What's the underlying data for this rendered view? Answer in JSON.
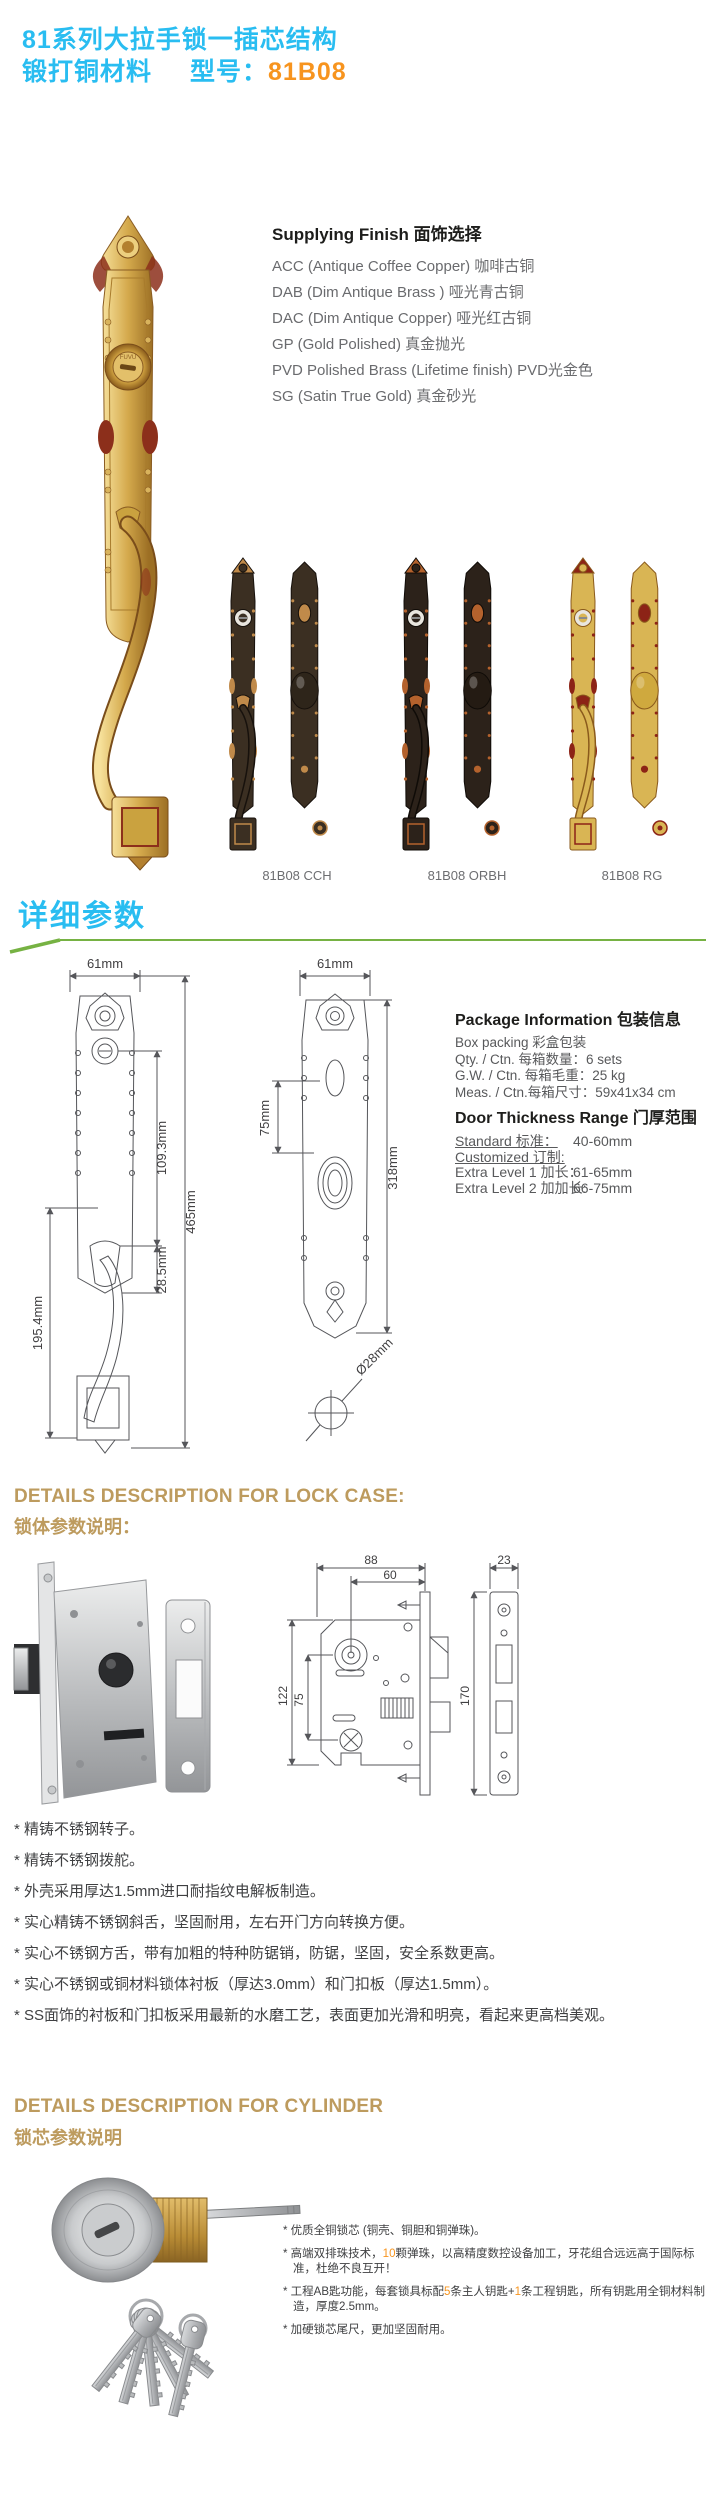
{
  "colors": {
    "title_cyan": "#29bdf1",
    "model_orange": "#f7941e",
    "section_green": "#76b243",
    "gold_heading": "#bd9b5e",
    "highlight_orange": "#f7941e"
  },
  "brand": "FUVU",
  "header": {
    "line1": "81系列大拉手锁一插芯结构",
    "material": "锻打铜材料",
    "model_label": "型号：",
    "model": "81B08"
  },
  "finishes": {
    "heading": "Supplying Finish 面饰选择",
    "items": [
      "ACC (Antique Coffee Copper) 咖啡古铜",
      "DAB (Dim Antique Brass ) 哑光青古铜",
      "DAC (Dim Antique Copper) 哑光红古铜",
      "GP (Gold Polished) 真金抛光",
      "PVD Polished Brass (Lifetime finish) PVD光金色",
      "SG (Satin True Gold) 真金砂光"
    ]
  },
  "variants": {
    "labels": [
      "81B08 CCH",
      "81B08 ORBH",
      "81B08 RG"
    ]
  },
  "params": {
    "heading": "详细参数",
    "front_dims": {
      "width": "61mm",
      "upper": "109.3mm",
      "total": "465mm",
      "thumb": "28.5mm",
      "grip": "195.4mm"
    },
    "back_dims": {
      "width": "61mm",
      "knob": "75mm",
      "total": "318mm",
      "rose": "Ø28mm"
    }
  },
  "package": {
    "heading": "Package Information 包装信息",
    "lines": [
      "Box packing 彩盒包装",
      "Qty. / Ctn. 每箱数量：6 sets",
      "G.W. / Ctn. 每箱毛重：25 kg",
      "Meas. / Ctn.每箱尺寸：59x41x34 cm"
    ]
  },
  "door_thickness": {
    "heading": "Door Thickness Range 门厚范围",
    "standard_label": "Standard 标准：",
    "standard_value": "40-60mm",
    "customized_label": "Customized 订制:",
    "extra1_label": "Extra Level 1 加长：",
    "extra1_value": "61-65mm",
    "extra2_label": "Extra Level 2 加加长:",
    "extra2_value": "66-75mm"
  },
  "lock_case": {
    "heading_en": "DETAILS DESCRIPTION FOR LOCK CASE:",
    "heading_cn": "锁体参数说明：",
    "dims": {
      "case_width": "88",
      "backset": "60",
      "case_height": "122",
      "centers": "75",
      "faceplate_height": "170",
      "faceplate_width": "23"
    },
    "bullets": [
      "* 精铸不锈钢转子。",
      "* 精铸不锈钢拨舵。",
      "* 外壳采用厚达1.5mm进口耐指纹电解板制造。",
      "* 实心精铸不锈钢斜舌，坚固耐用，左右开门方向转换方便。",
      "* 实心不锈钢方舌，带有加粗的特种防锯销，防锯，坚固，安全系数更高。",
      "* 实心不锈钢或铜材料锁体衬板（厚达3.0mm）和门扣板（厚达1.5mm）。",
      "* SS面饰的衬板和门扣板采用最新的水磨工艺，表面更加光滑和明亮，看起来更高档美观。"
    ]
  },
  "cylinder": {
    "heading_en": "DETAILS DESCRIPTION FOR CYLINDER",
    "heading_cn": "锁芯参数说明",
    "b1": "* 优质全铜锁芯 (铜壳、铜胆和铜弹珠)。",
    "b2_pre": "* 高端双排珠技术，",
    "b2_num": "10",
    "b2_post": "颗弹珠，以高精度数控设备加工，牙花组合远远高于国际标准，杜绝不良互开！",
    "b3_pre": "* 工程AB匙功能，每套锁具标配",
    "b3_num1": "5",
    "b3_mid": "条主人钥匙+",
    "b3_num2": "1",
    "b3_post": "条工程钥匙，所有钥匙用全铜材料制造，厚度2.5mm。",
    "b4": "* 加硬锁芯尾尺，更加坚固耐用。"
  }
}
